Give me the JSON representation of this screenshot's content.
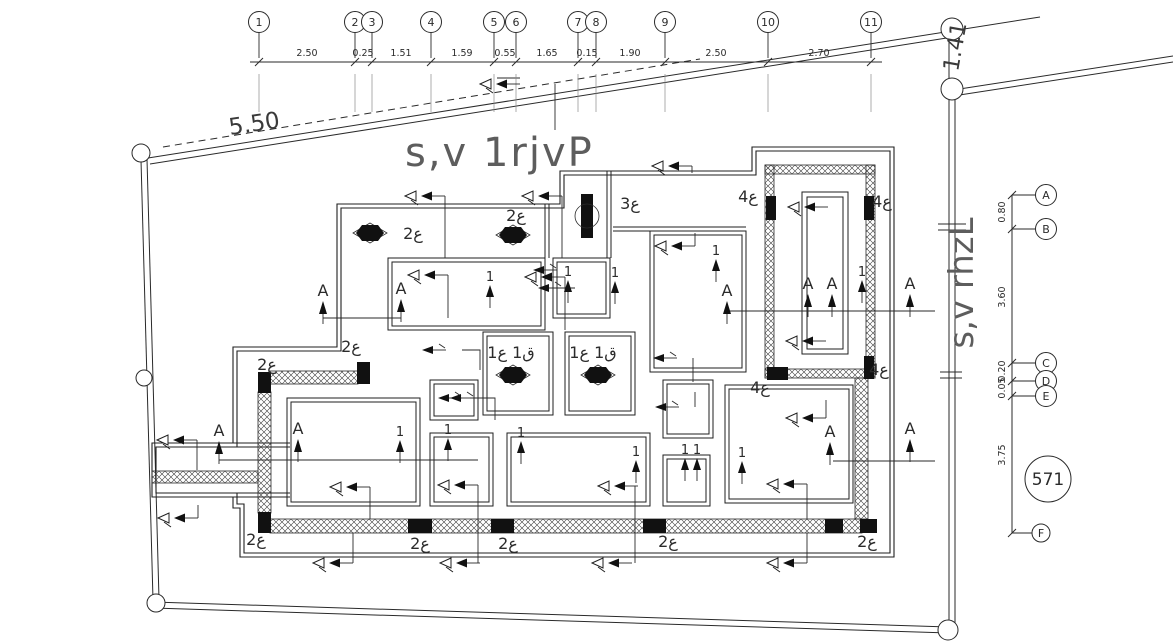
{
  "drawing": {
    "plan_title": "s,v 1rjvP",
    "side_title": "s,v rhzL",
    "boundary_dim_top": "5.50",
    "boundary_dim_right": "1.41",
    "detail_bubble": "571"
  },
  "top_grid": {
    "bubbles": [
      {
        "label": "1",
        "x": 259
      },
      {
        "label": "2",
        "x": 355
      },
      {
        "label": "3",
        "x": 372
      },
      {
        "label": "4",
        "x": 431
      },
      {
        "label": "5",
        "x": 494
      },
      {
        "label": "6",
        "x": 516
      },
      {
        "label": "7",
        "x": 578
      },
      {
        "label": "8",
        "x": 596
      },
      {
        "label": "9",
        "x": 665
      },
      {
        "label": "10",
        "x": 768
      },
      {
        "label": "11",
        "x": 871
      }
    ],
    "dims": [
      {
        "value": "2.50",
        "x": 307
      },
      {
        "value": "0.25",
        "x": 363
      },
      {
        "value": "1.51",
        "x": 401
      },
      {
        "value": "1.59",
        "x": 462
      },
      {
        "value": "0.55",
        "x": 505
      },
      {
        "value": "1.65",
        "x": 547
      },
      {
        "value": "0.15",
        "x": 587
      },
      {
        "value": "1.90",
        "x": 630
      },
      {
        "value": "2.50",
        "x": 716
      },
      {
        "value": "2.70",
        "x": 819
      }
    ]
  },
  "right_grid": {
    "bubbles": [
      {
        "label": "A",
        "y": 195
      },
      {
        "label": "B",
        "y": 229
      },
      {
        "label": "C",
        "y": 363
      },
      {
        "label": "D",
        "y": 381
      },
      {
        "label": "E",
        "y": 396
      },
      {
        "label": "F",
        "y": 533,
        "x": 1041,
        "r": 9
      }
    ],
    "dims": [
      {
        "value": "0.80",
        "y": 212
      },
      {
        "value": "3.60",
        "y": 297
      },
      {
        "value": "0.20",
        "y": 371
      },
      {
        "value": "0.05",
        "y": 388
      },
      {
        "value": "3.75",
        "y": 455
      }
    ]
  },
  "room_labels": [
    {
      "text": "2ع",
      "x": 413,
      "y": 239
    },
    {
      "text": "2ع",
      "x": 516,
      "y": 221
    },
    {
      "text": "3ع",
      "x": 630,
      "y": 209
    },
    {
      "text": "2ع",
      "x": 351,
      "y": 352
    },
    {
      "text": "2ع",
      "x": 267,
      "y": 370
    },
    {
      "text": "2ع",
      "x": 256,
      "y": 545
    },
    {
      "text": "2ع",
      "x": 420,
      "y": 549
    },
    {
      "text": "2ع",
      "x": 508,
      "y": 549
    },
    {
      "text": "2ع",
      "x": 668,
      "y": 547
    },
    {
      "text": "2ع",
      "x": 867,
      "y": 547
    },
    {
      "text": "4ع",
      "x": 748,
      "y": 202
    },
    {
      "text": "4ع",
      "x": 882,
      "y": 207
    },
    {
      "text": "4ع",
      "x": 760,
      "y": 393
    },
    {
      "text": "4ع",
      "x": 879,
      "y": 375
    },
    {
      "text": "1ع 1ق",
      "x": 511,
      "y": 358
    },
    {
      "text": "1ع 1ق",
      "x": 593,
      "y": 358
    }
  ],
  "section_markers": [
    {
      "text": "A",
      "x": 323,
      "y": 296
    },
    {
      "text": "A",
      "x": 401,
      "y": 294
    },
    {
      "text": "A",
      "x": 727,
      "y": 296
    },
    {
      "text": "A",
      "x": 808,
      "y": 289
    },
    {
      "text": "A",
      "x": 832,
      "y": 289
    },
    {
      "text": "A",
      "x": 910,
      "y": 289
    },
    {
      "text": "A",
      "x": 219,
      "y": 436
    },
    {
      "text": "A",
      "x": 298,
      "y": 434
    },
    {
      "text": "A",
      "x": 830,
      "y": 437
    },
    {
      "text": "A",
      "x": 910,
      "y": 434
    }
  ],
  "circuit_numbers": [
    {
      "text": "1",
      "x": 490,
      "y": 281
    },
    {
      "text": "1",
      "x": 568,
      "y": 276
    },
    {
      "text": "1",
      "x": 615,
      "y": 277
    },
    {
      "text": "1",
      "x": 716,
      "y": 255
    },
    {
      "text": "1",
      "x": 862,
      "y": 276
    },
    {
      "text": "1",
      "x": 400,
      "y": 436
    },
    {
      "text": "1",
      "x": 448,
      "y": 434
    },
    {
      "text": "1",
      "x": 521,
      "y": 437
    },
    {
      "text": "1",
      "x": 636,
      "y": 456
    },
    {
      "text": "1",
      "x": 685,
      "y": 454
    },
    {
      "text": "1",
      "x": 697,
      "y": 454
    },
    {
      "text": "1",
      "x": 742,
      "y": 457
    }
  ],
  "fan_symbols": [
    {
      "type": "ceiling",
      "x": 370,
      "y": 233
    },
    {
      "type": "ceiling",
      "x": 513,
      "y": 235
    },
    {
      "type": "ceiling",
      "x": 513,
      "y": 375
    },
    {
      "type": "ceiling",
      "x": 598,
      "y": 375
    },
    {
      "type": "wall",
      "x": 587,
      "y": 216
    }
  ],
  "switch_arrows": [
    {
      "x": 480,
      "y": 84
    },
    {
      "x": 405,
      "y": 196
    },
    {
      "x": 522,
      "y": 196
    },
    {
      "x": 652,
      "y": 166
    },
    {
      "x": 655,
      "y": 246
    },
    {
      "x": 408,
      "y": 275
    },
    {
      "x": 525,
      "y": 277
    },
    {
      "x": 788,
      "y": 207
    },
    {
      "x": 786,
      "y": 341
    },
    {
      "x": 157,
      "y": 440
    },
    {
      "x": 158,
      "y": 518
    },
    {
      "x": 330,
      "y": 487
    },
    {
      "x": 438,
      "y": 485
    },
    {
      "x": 598,
      "y": 486
    },
    {
      "x": 767,
      "y": 484
    },
    {
      "x": 786,
      "y": 418
    },
    {
      "x": 313,
      "y": 563
    },
    {
      "x": 440,
      "y": 563
    },
    {
      "x": 592,
      "y": 563
    },
    {
      "x": 767,
      "y": 563
    }
  ],
  "branch_arrows": [
    {
      "x": 533,
      "y": 270
    },
    {
      "x": 538,
      "y": 288
    },
    {
      "x": 422,
      "y": 350
    },
    {
      "x": 653,
      "y": 358
    },
    {
      "x": 655,
      "y": 407
    },
    {
      "x": 438,
      "y": 398
    },
    {
      "x": 450,
      "y": 398
    }
  ]
}
